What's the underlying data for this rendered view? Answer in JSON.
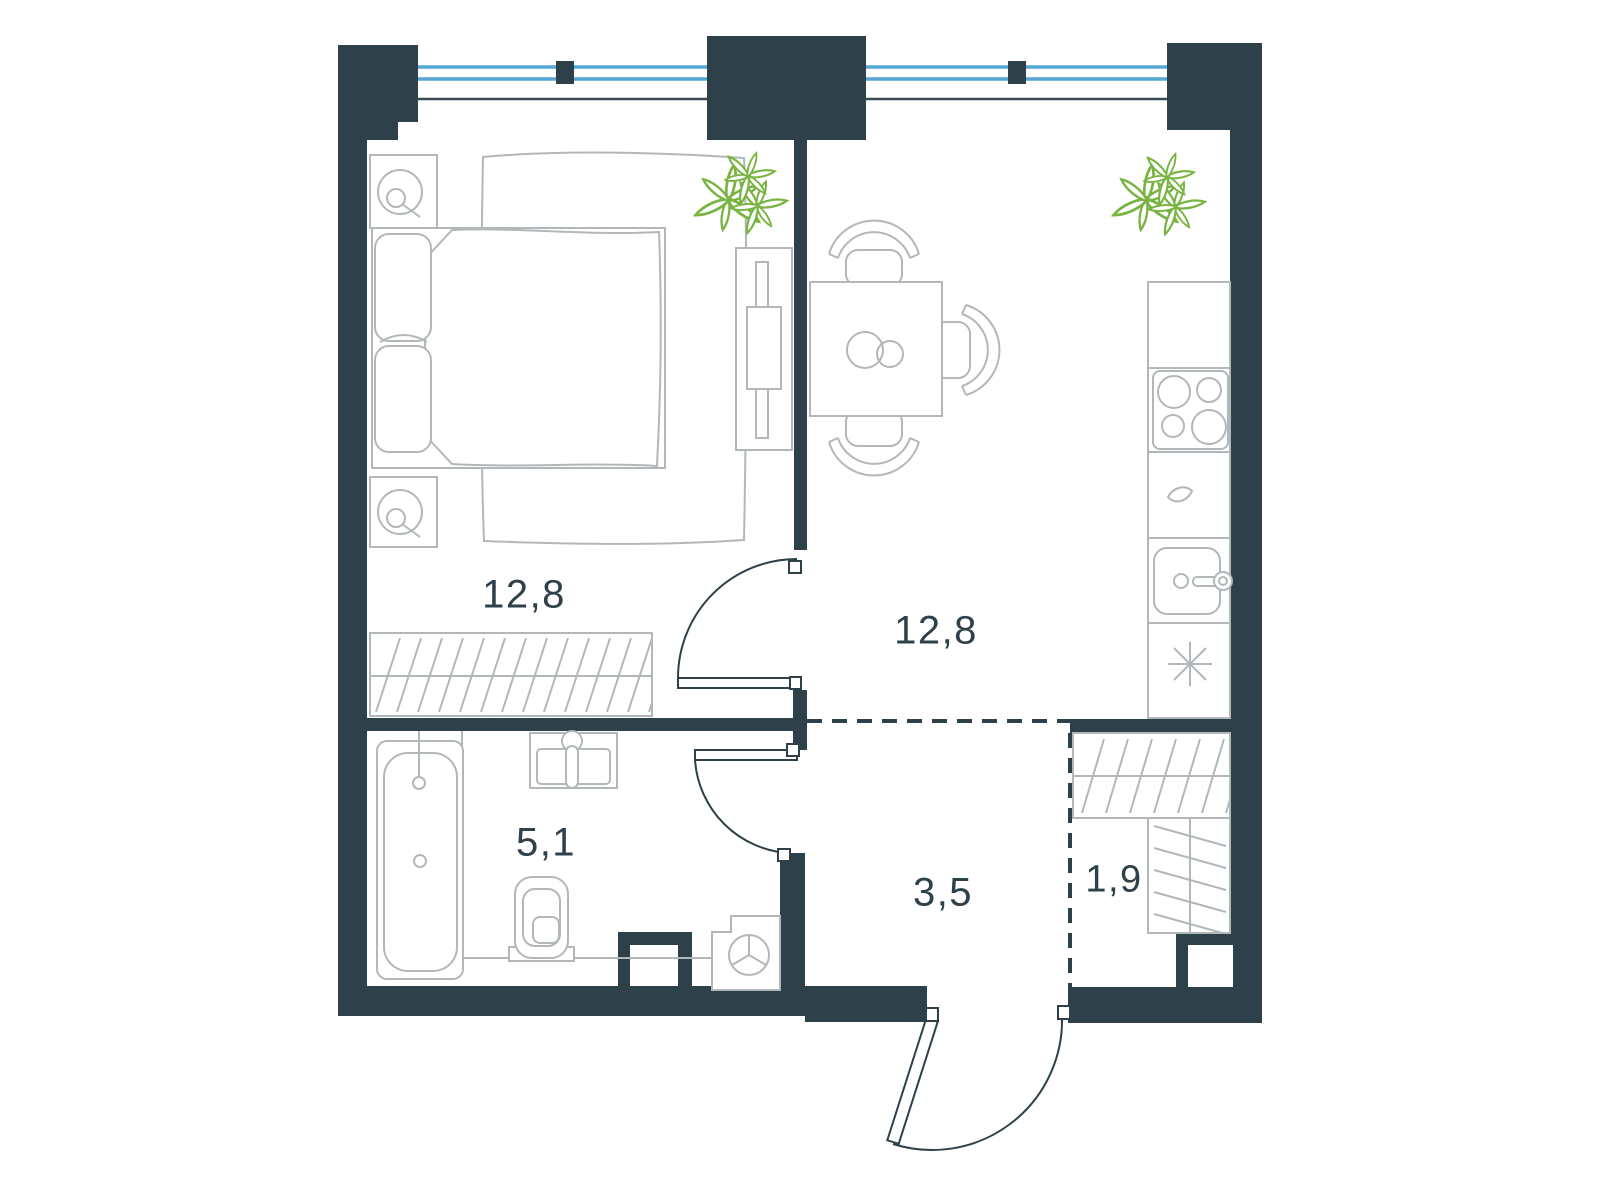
{
  "plan": {
    "title": "one-room apartment floor plan",
    "rooms": [
      {
        "name": "bedroom",
        "area_label": "12,8"
      },
      {
        "name": "kitchen-living-room",
        "area_label": "12,8"
      },
      {
        "name": "bathroom",
        "area_label": "5,1"
      },
      {
        "name": "hallway",
        "area_label": "3,5"
      },
      {
        "name": "wardrobe",
        "area_label": "1,9"
      }
    ],
    "furniture_symbols": [
      "double-bed",
      "pillows",
      "duvet",
      "rug",
      "nightstand-with-lamp",
      "wardrobe-rail-hatched",
      "tv-console",
      "potted-plant",
      "dining-table",
      "dining-chair",
      "plates",
      "kitchen-counter",
      "cooktop-4-burners",
      "kitchen-sink-with-faucet",
      "refrigerator-asterisk",
      "bathtub",
      "washbasin",
      "toilet",
      "washing-machine",
      "duct-shaft",
      "shelving-unit",
      "swing-door",
      "entrance-door",
      "window-double-glazing"
    ]
  },
  "colors": {
    "wall": "#2e4049",
    "furniture_line": "#b2b8ba",
    "window_glass": "#55a7d6",
    "plant": "#79b442",
    "label_text": "#2e4049",
    "background": "#ffffff"
  }
}
